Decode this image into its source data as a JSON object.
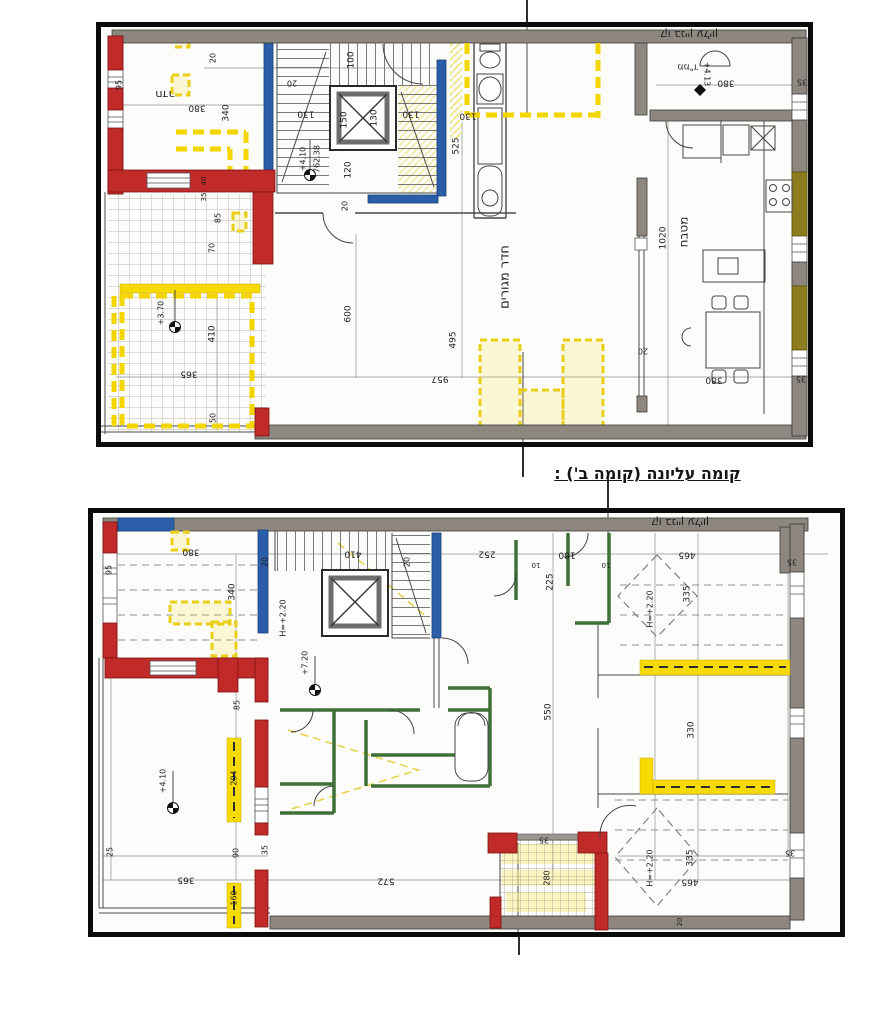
{
  "document": {
    "caption": "קומה עליונה (קומה ב') :",
    "background": "#ffffff"
  },
  "colors": {
    "wall_gray": "#8d8780",
    "wall_red": "#c02a28",
    "wall_blue": "#2b5ea9",
    "wall_olive": "#8e7d1f",
    "wall_green": "#3f7038",
    "highlight_yellow": "#f6da00",
    "frame_black": "#0c0c0c"
  },
  "plan_top": {
    "name": "floor-plan-a",
    "labels": [
      {
        "t": "קו בניין עליון",
        "x": 593,
        "y": 12,
        "r": 180,
        "s": 11
      },
      {
        "t": "חדר",
        "x": 69,
        "y": 72,
        "r": 180,
        "s": 11
      },
      {
        "t": "380",
        "x": 101,
        "y": 86,
        "r": 180
      },
      {
        "t": "340",
        "x": 130,
        "y": 91,
        "r": -90
      },
      {
        "t": "20",
        "x": 117,
        "y": 36,
        "r": -90,
        "s": 8
      },
      {
        "t": "20",
        "x": 196,
        "y": 61,
        "r": 180,
        "s": 8
      },
      {
        "t": "100",
        "x": 255,
        "y": 38,
        "r": -90
      },
      {
        "t": "130",
        "x": 210,
        "y": 92,
        "r": 180
      },
      {
        "t": "150",
        "x": 248,
        "y": 98,
        "r": -90
      },
      {
        "t": "130",
        "x": 278,
        "y": 96,
        "r": -90
      },
      {
        "t": "130",
        "x": 315,
        "y": 92,
        "r": 180
      },
      {
        "t": "130",
        "x": 372,
        "y": 94,
        "r": 180
      },
      {
        "t": "+4.10",
        "x": 207,
        "y": 137,
        "r": -90,
        "s": 8
      },
      {
        "t": "762.38",
        "x": 221,
        "y": 137,
        "r": -90,
        "s": 8
      },
      {
        "t": "120",
        "x": 252,
        "y": 148,
        "r": -90
      },
      {
        "t": "20",
        "x": 249,
        "y": 184,
        "r": -90,
        "s": 8
      },
      {
        "t": "525",
        "x": 360,
        "y": 124,
        "r": -90
      },
      {
        "t": "600",
        "x": 252,
        "y": 292,
        "r": -90
      },
      {
        "t": "495",
        "x": 357,
        "y": 318,
        "r": -90
      },
      {
        "t": "957",
        "x": 344,
        "y": 357,
        "r": 180
      },
      {
        "t": "חדר מגורים",
        "x": 409,
        "y": 255,
        "r": -90,
        "s": 13
      },
      {
        "t": "20",
        "x": 547,
        "y": 329,
        "r": 180,
        "s": 8
      },
      {
        "t": "1020",
        "x": 567,
        "y": 216,
        "r": -90
      },
      {
        "t": "מטבח",
        "x": 588,
        "y": 210,
        "r": -90,
        "s": 12
      },
      {
        "t": "380",
        "x": 618,
        "y": 358,
        "r": 180
      },
      {
        "t": "35",
        "x": 705,
        "y": 357,
        "r": 180,
        "s": 8
      },
      {
        "t": "35",
        "x": 706,
        "y": 60,
        "r": 180,
        "s": 8
      },
      {
        "t": "ממ\"ד",
        "x": 592,
        "y": 45,
        "r": 180,
        "s": 9
      },
      {
        "t": "+4.13",
        "x": 611,
        "y": 52,
        "r": 90,
        "s": 8
      },
      {
        "t": "380",
        "x": 630,
        "y": 61,
        "r": 180
      },
      {
        "t": "95",
        "x": 23,
        "y": 63,
        "r": -90,
        "s": 8
      },
      {
        "t": "40",
        "x": 108,
        "y": 159,
        "r": -90,
        "s": 7
      },
      {
        "t": "35",
        "x": 108,
        "y": 175,
        "r": -90,
        "s": 7
      },
      {
        "t": "85",
        "x": 122,
        "y": 196,
        "r": -90,
        "s": 8
      },
      {
        "t": "70",
        "x": 116,
        "y": 226,
        "r": -90,
        "s": 8
      },
      {
        "t": "+3.70",
        "x": 65,
        "y": 291,
        "r": -90,
        "s": 8
      },
      {
        "t": "410",
        "x": 116,
        "y": 312,
        "r": -90
      },
      {
        "t": "365",
        "x": 93,
        "y": 352,
        "r": 180
      },
      {
        "t": "50",
        "x": 117,
        "y": 396,
        "r": -90,
        "s": 8
      }
    ]
  },
  "plan_bottom": {
    "name": "floor-plan-b",
    "labels": [
      {
        "t": "קו בניין עליון",
        "x": 592,
        "y": 14,
        "r": 180,
        "s": 11
      },
      {
        "t": "380",
        "x": 103,
        "y": 44,
        "r": 180
      },
      {
        "t": "20",
        "x": 177,
        "y": 54,
        "r": -90,
        "s": 8
      },
      {
        "t": "340",
        "x": 144,
        "y": 84,
        "r": -90
      },
      {
        "t": "410",
        "x": 265,
        "y": 46,
        "r": 180
      },
      {
        "t": "20",
        "x": 319,
        "y": 54,
        "r": -90,
        "s": 8
      },
      {
        "t": "252",
        "x": 399,
        "y": 46,
        "r": 180
      },
      {
        "t": "180",
        "x": 479,
        "y": 47,
        "r": 180
      },
      {
        "t": "10",
        "x": 448,
        "y": 57,
        "r": 180,
        "s": 7
      },
      {
        "t": "10",
        "x": 518,
        "y": 57,
        "r": 180,
        "s": 7
      },
      {
        "t": "225",
        "x": 462,
        "y": 74,
        "r": -90
      },
      {
        "t": "465",
        "x": 599,
        "y": 47,
        "r": 180
      },
      {
        "t": "35",
        "x": 704,
        "y": 54,
        "r": 180,
        "s": 8
      },
      {
        "t": "335",
        "x": 599,
        "y": 86,
        "r": -90
      },
      {
        "t": "H=+2.20",
        "x": 562,
        "y": 101,
        "r": -90,
        "s": 8
      },
      {
        "t": "H=+2.20",
        "x": 195,
        "y": 110,
        "r": -90,
        "s": 8
      },
      {
        "t": "+7.20",
        "x": 217,
        "y": 155,
        "r": -90,
        "s": 8
      },
      {
        "t": "85",
        "x": 149,
        "y": 197,
        "r": -90,
        "s": 8
      },
      {
        "t": "550",
        "x": 460,
        "y": 204,
        "r": -90
      },
      {
        "t": "330",
        "x": 603,
        "y": 222,
        "r": -90
      },
      {
        "t": "294",
        "x": 146,
        "y": 270,
        "r": -90,
        "s": 8
      },
      {
        "t": "+4.10",
        "x": 75,
        "y": 273,
        "r": -90,
        "s": 8
      },
      {
        "t": "H=+2.20",
        "x": 562,
        "y": 360,
        "r": -90,
        "s": 8
      },
      {
        "t": "335",
        "x": 602,
        "y": 350,
        "r": -90
      },
      {
        "t": "465",
        "x": 602,
        "y": 374,
        "r": 180
      },
      {
        "t": "35",
        "x": 702,
        "y": 345,
        "r": 180,
        "s": 8
      },
      {
        "t": "25",
        "x": 22,
        "y": 344,
        "r": -90,
        "s": 8
      },
      {
        "t": "90",
        "x": 148,
        "y": 345,
        "r": -90,
        "s": 8
      },
      {
        "t": "35",
        "x": 177,
        "y": 342,
        "r": -90,
        "s": 8
      },
      {
        "t": "365",
        "x": 98,
        "y": 372,
        "r": 180
      },
      {
        "t": "160",
        "x": 146,
        "y": 390,
        "r": -90,
        "s": 8
      },
      {
        "t": "572",
        "x": 298,
        "y": 373,
        "r": 180
      },
      {
        "t": "35",
        "x": 456,
        "y": 332,
        "r": 180,
        "s": 8
      },
      {
        "t": "280",
        "x": 459,
        "y": 370,
        "r": -90,
        "s": 8
      },
      {
        "t": "95",
        "x": 21,
        "y": 62,
        "r": -90,
        "s": 8
      },
      {
        "t": "20",
        "x": 592,
        "y": 414,
        "r": -90,
        "s": 7
      }
    ]
  }
}
